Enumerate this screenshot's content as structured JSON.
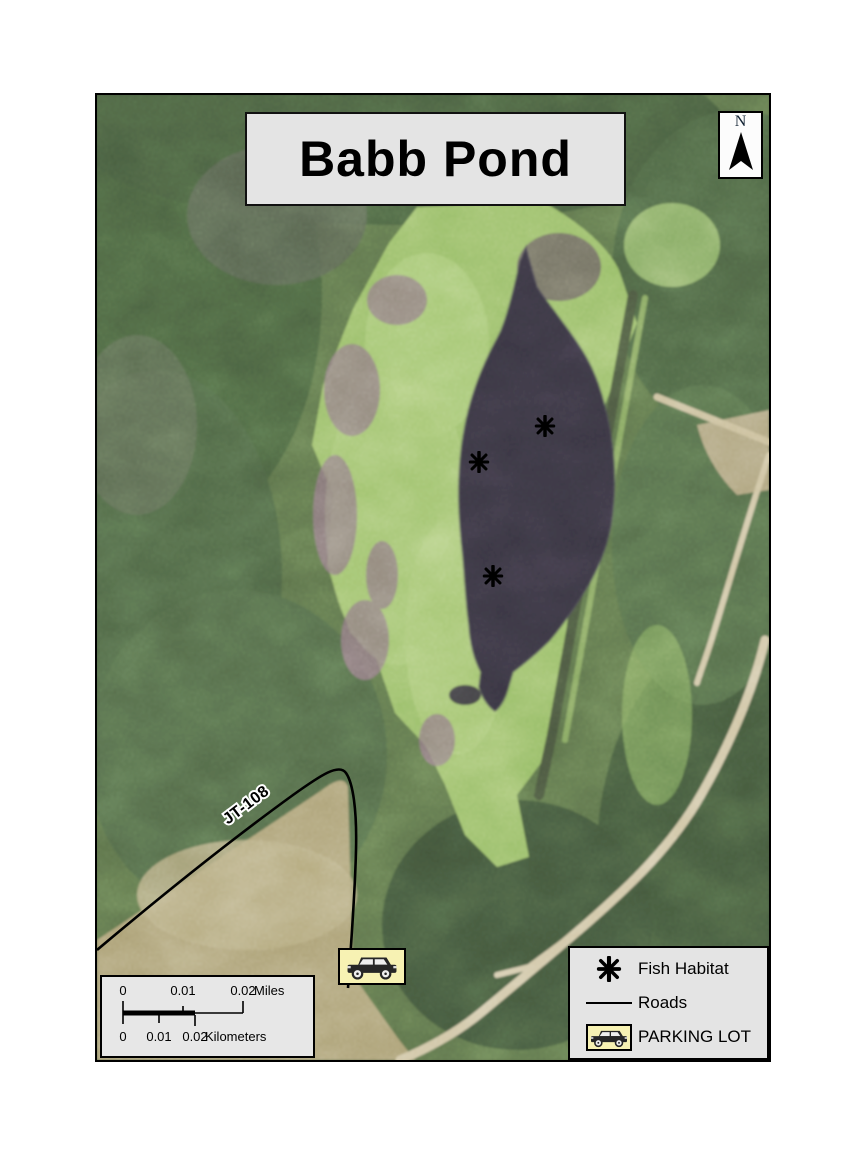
{
  "map_title": {
    "text": "Babb Pond"
  },
  "north_arrow": {
    "label": "N"
  },
  "map": {
    "road_label": "JT-108",
    "fish_habitat_points": [
      {
        "x": 448,
        "y": 331
      },
      {
        "x": 382,
        "y": 367
      },
      {
        "x": 396,
        "y": 481
      }
    ],
    "colors": {
      "forest_green": "#50664489",
      "forest_base": "#5b7049",
      "meadow_green": "#96bc66",
      "pond_dark": "#37333f",
      "field_tan": "#ab9f74",
      "trail_tan": "#d0c5a4",
      "road_black": "#000000",
      "panel_gray": "#e4e4e4",
      "parking_yellow": "#f7f2b3"
    }
  },
  "scale_bar": {
    "miles": {
      "t0": "0",
      "t1": "0.01",
      "t2": "0.02",
      "unit": "Miles"
    },
    "kilometers": {
      "t0": "0",
      "t1": "0.01",
      "t2": "0.02",
      "unit": "Kilometers"
    }
  },
  "legend": {
    "items": [
      {
        "label": "Fish Habitat",
        "symbol": "asterisk-marker"
      },
      {
        "label": "Roads",
        "symbol": "road-line"
      },
      {
        "label": "PARKING LOT",
        "symbol": "parking-car-icon"
      }
    ]
  }
}
